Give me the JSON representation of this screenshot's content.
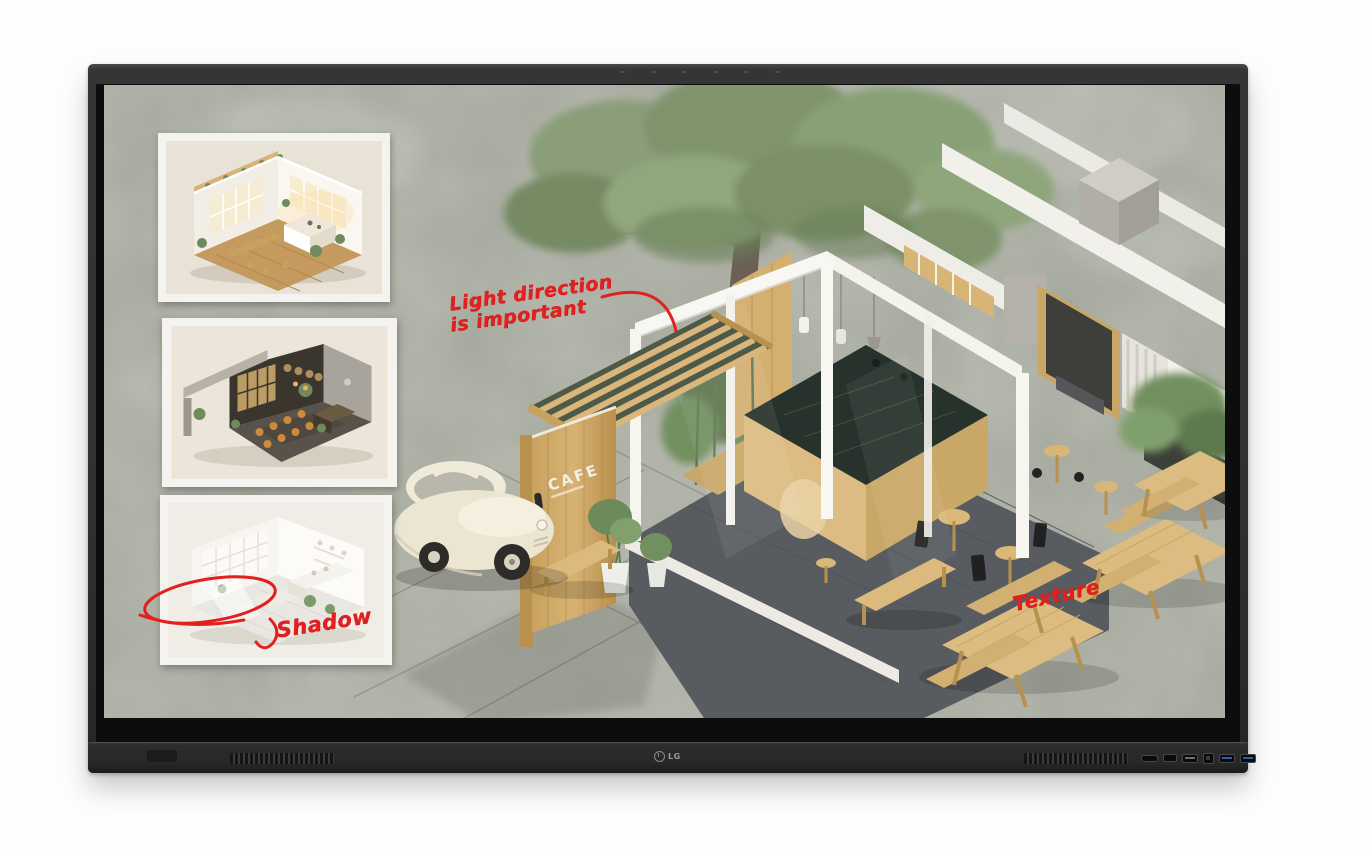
{
  "device": {
    "brand": "LG",
    "logo_text": "LG",
    "bezel_color": "#2f2f2f",
    "mic_dot_count": 6,
    "speaker_grille_count": 2,
    "ports": [
      "card-slot-port",
      "hdmi-port",
      "usb-a-port",
      "usb-b-touch-port",
      "usb3-port",
      "usb3-port"
    ]
  },
  "screen": {
    "background_color": "#a8ab9f",
    "ink_color": "#e2201f",
    "wood_color": "#d7b77c",
    "wall_color": "#f6f5f0",
    "annotations": {
      "light": {
        "line1": "Light direction",
        "line2": "is important"
      },
      "shadow": {
        "text": "Shadow"
      },
      "texture": {
        "text": "Texture"
      }
    },
    "cafe_sign": {
      "text": "CAFE"
    },
    "thumbnails": [
      {
        "name": "warm-wood-cafe-interior-render"
      },
      {
        "name": "dark-moody-cafe-interior-render"
      },
      {
        "name": "bright-white-room-render-with-red-circle"
      }
    ]
  }
}
